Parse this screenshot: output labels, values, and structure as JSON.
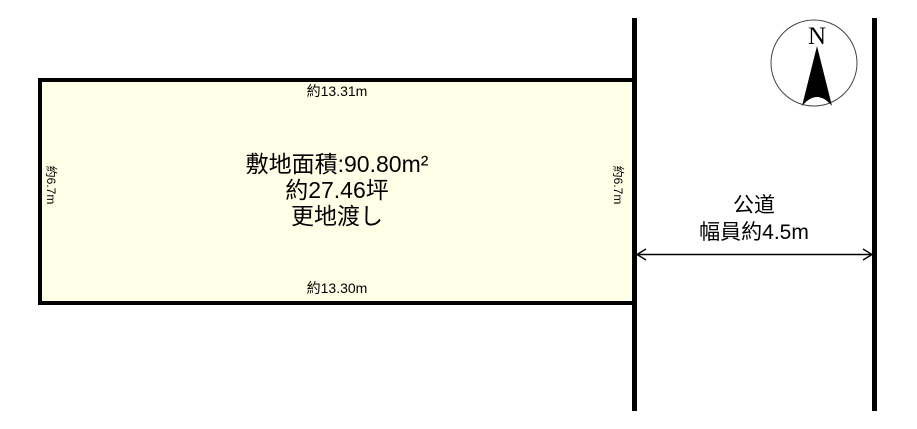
{
  "parcel": {
    "fill_color": "#FFFFE8",
    "border_color": "#000000",
    "area_m2": "敷地面積:90.80m²",
    "area_tsubo": "約27.46坪",
    "handover": "更地渡し",
    "dim_top": "約13.31m",
    "dim_bottom": "約13.30m",
    "dim_left": "約6.7m",
    "dim_right": "約6.7m"
  },
  "road": {
    "name": "公道",
    "width_label": "幅員約4.5m"
  },
  "compass": {
    "north_label": "N"
  }
}
